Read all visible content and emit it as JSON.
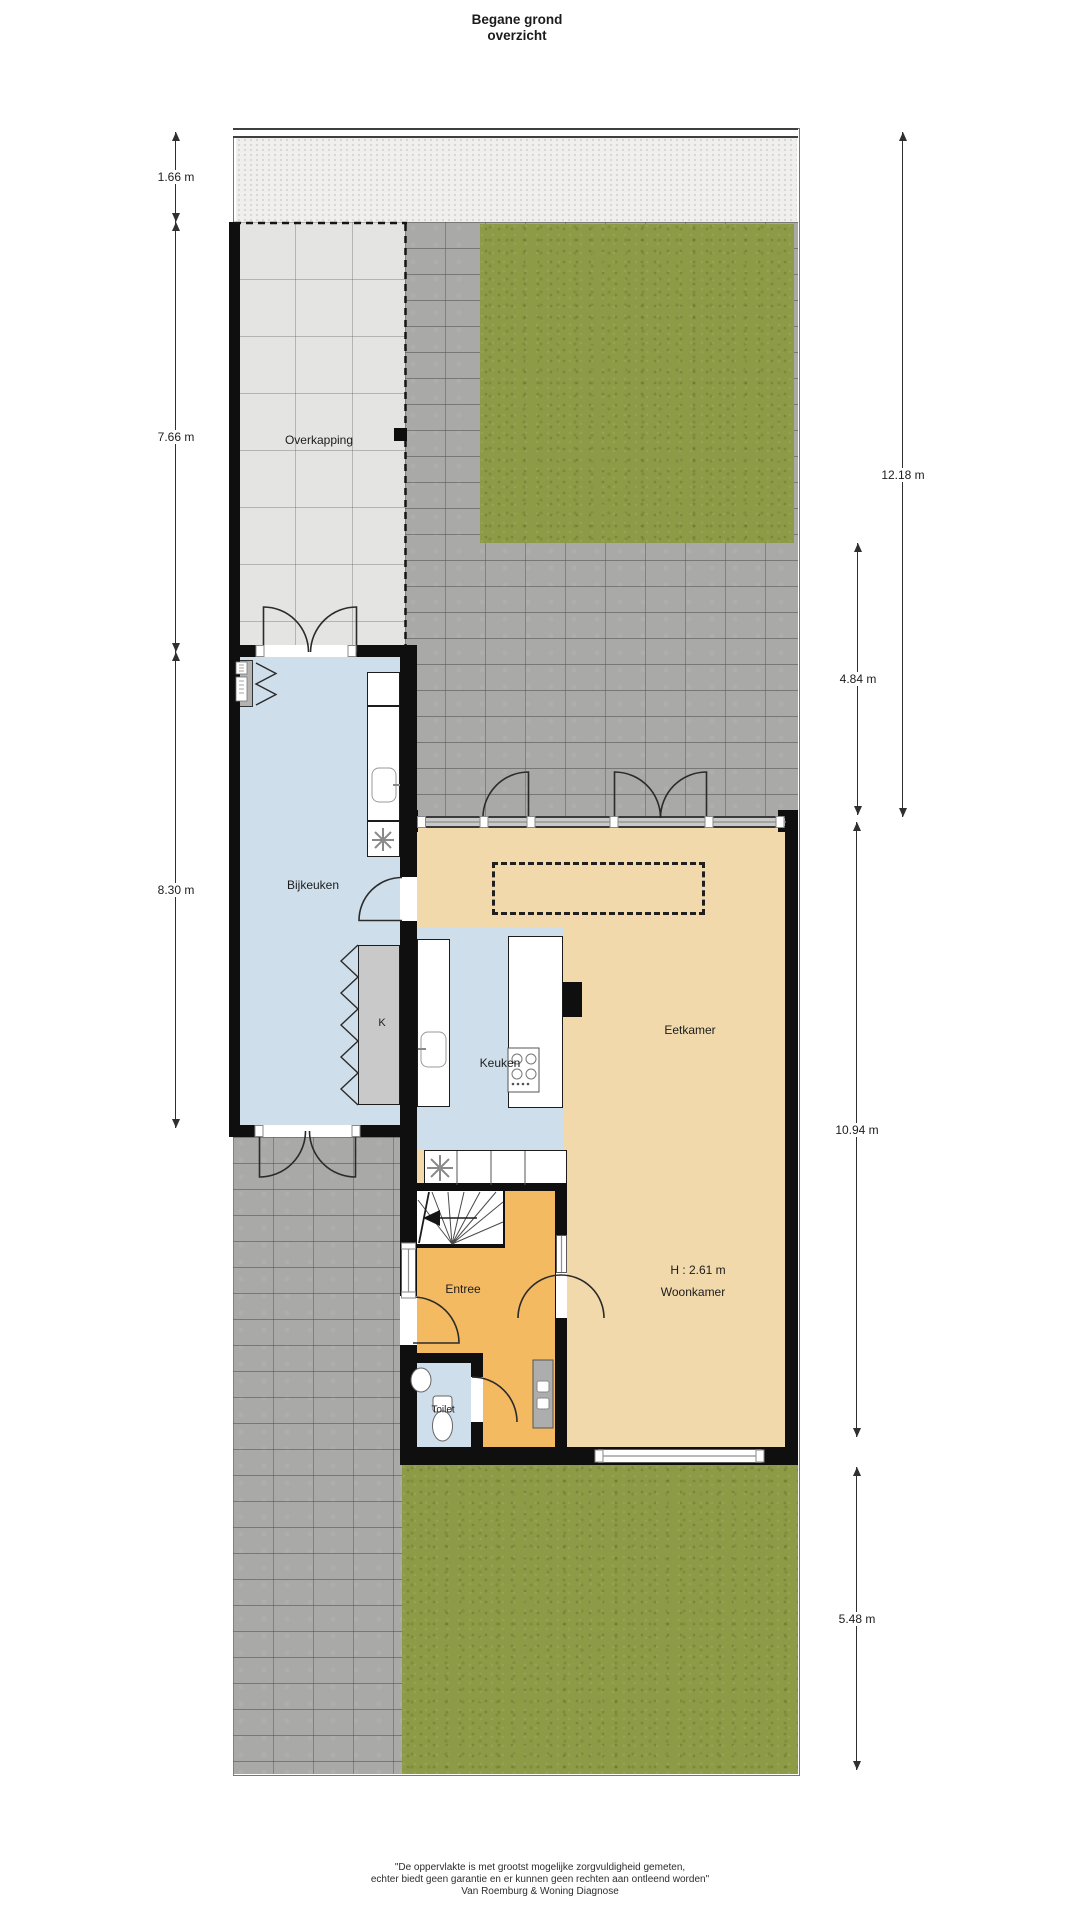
{
  "title": {
    "line1": "Begane grond",
    "line2": "overzicht"
  },
  "rooms": {
    "overkapping": "Overkapping",
    "bijkeuken": "Bijkeuken",
    "kast": "K",
    "keuken": "Keuken",
    "eetkamer": "Eetkamer",
    "entree": "Entree",
    "toilet": "Toilet",
    "woonkamer": "Woonkamer",
    "woonkamer_height": "H : 2.61 m"
  },
  "dims": {
    "left": [
      {
        "value": "1.66 m"
      },
      {
        "value": "7.66 m"
      },
      {
        "value": "8.30 m"
      }
    ],
    "right": [
      {
        "value": "12.18 m"
      },
      {
        "value": "4.84 m"
      },
      {
        "value": "10.94 m"
      },
      {
        "value": "5.48 m"
      }
    ]
  },
  "footer": {
    "line1": "\"De oppervlakte is met grootst mogelijke zorgvuldigheid gemeten,",
    "line2": "echter biedt geen garantie en er kunnen geen rechten aan ontleend worden\"",
    "line3": "Van Roemburg & Woning Diagnose"
  },
  "colors": {
    "grass": "#8d9a46",
    "paving": "#a9a9a7",
    "overkapping_tiles": "#e4e4e2",
    "back_path": "#f0efed",
    "floor_living": "#f2d9ab",
    "floor_entree": "#f4ba62",
    "floor_wet": "#cfdeeb",
    "closet": "#c9c9c9",
    "wall": "#0f0f0f"
  }
}
